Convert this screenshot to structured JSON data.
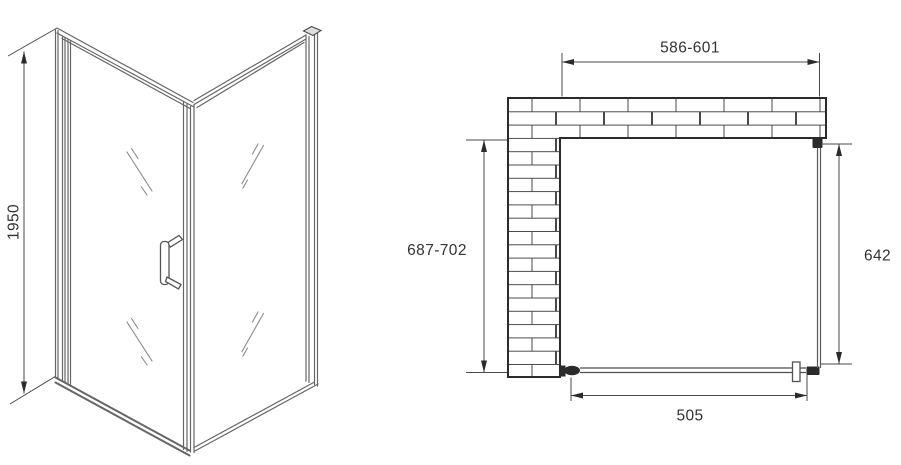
{
  "drawing": {
    "front_view": {
      "height_label": "1950"
    },
    "plan_view": {
      "width_label": "586-601",
      "depth_label": "687-702",
      "side_panel_label": "642",
      "door_width_label": "505"
    }
  },
  "colors": {
    "line": "#4a4a4a",
    "outline": "#2b2b2b",
    "frame": "#666666",
    "glass-mark": "#8a8a8a",
    "text": "#333333",
    "bg": "#ffffff"
  }
}
